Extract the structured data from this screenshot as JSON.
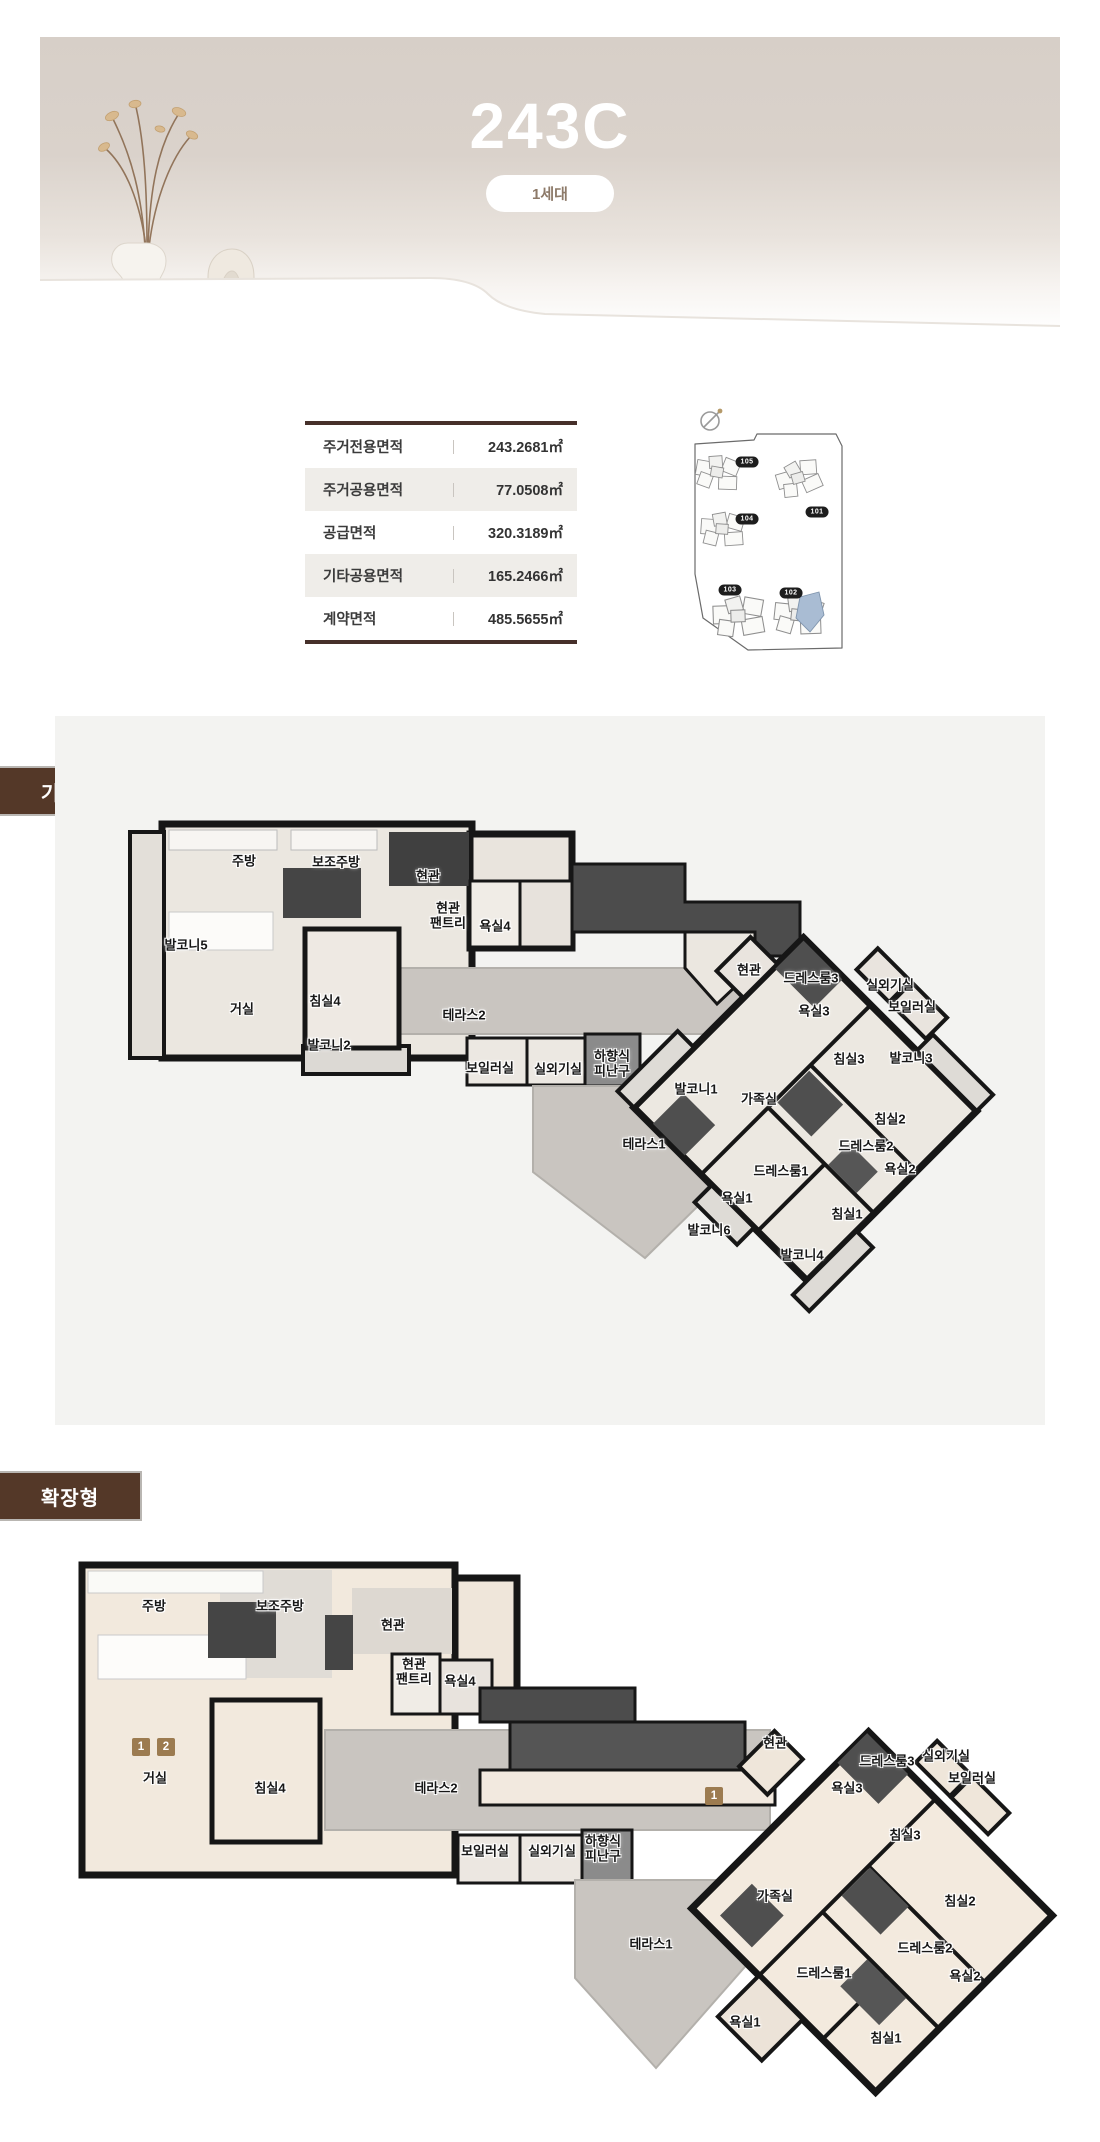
{
  "banner": {
    "unit_name": "243C",
    "household_badge": "1세대"
  },
  "area_table": {
    "rows": [
      {
        "label": "주거전용면적",
        "value": "243.2681㎡"
      },
      {
        "label": "주거공용면적",
        "value": "77.0508㎡"
      },
      {
        "label": "공급면적",
        "value": "320.3189㎡"
      },
      {
        "label": "기타공용면적",
        "value": "165.2466㎡"
      },
      {
        "label": "계약면적",
        "value": "485.5655㎡"
      }
    ]
  },
  "site_map": {
    "highlighted_building": "102",
    "highlight_color": "#a9bcd3",
    "building_badges": [
      {
        "label": "105",
        "x": 61,
        "y": 59
      },
      {
        "label": "101",
        "x": 131,
        "y": 109
      },
      {
        "label": "104",
        "x": 61,
        "y": 116
      },
      {
        "label": "103",
        "x": 44,
        "y": 187
      },
      {
        "label": "102",
        "x": 105,
        "y": 190
      }
    ]
  },
  "sections": {
    "basic": {
      "title": "기본형",
      "rooms": [
        {
          "label": "주방",
          "x": 244,
          "y": 862
        },
        {
          "label": "보조주방",
          "x": 336,
          "y": 863
        },
        {
          "label": "현관",
          "x": 428,
          "y": 877
        },
        {
          "label": "현관\n팬트리",
          "x": 448,
          "y": 916
        },
        {
          "label": "욕실4",
          "x": 495,
          "y": 927
        },
        {
          "label": "발코니5",
          "x": 186,
          "y": 946
        },
        {
          "label": "거실",
          "x": 242,
          "y": 1010
        },
        {
          "label": "침실4",
          "x": 325,
          "y": 1002
        },
        {
          "label": "테라스2",
          "x": 464,
          "y": 1016
        },
        {
          "label": "발코니2",
          "x": 329,
          "y": 1046
        },
        {
          "label": "보일러실",
          "x": 490,
          "y": 1069
        },
        {
          "label": "실외기실",
          "x": 558,
          "y": 1070
        },
        {
          "label": "하향식\n피난구",
          "x": 612,
          "y": 1064
        },
        {
          "label": "현관",
          "x": 749,
          "y": 971
        },
        {
          "label": "드레스룸3",
          "x": 811,
          "y": 979
        },
        {
          "label": "실외기실",
          "x": 890,
          "y": 986
        },
        {
          "label": "욕실3",
          "x": 814,
          "y": 1012
        },
        {
          "label": "보일러실",
          "x": 912,
          "y": 1008
        },
        {
          "label": "침실3",
          "x": 849,
          "y": 1060
        },
        {
          "label": "발코니3",
          "x": 911,
          "y": 1059
        },
        {
          "label": "발코니1",
          "x": 696,
          "y": 1090
        },
        {
          "label": "가족실",
          "x": 759,
          "y": 1100
        },
        {
          "label": "침실2",
          "x": 890,
          "y": 1120
        },
        {
          "label": "드레스룸2",
          "x": 866,
          "y": 1147
        },
        {
          "label": "욕실2",
          "x": 900,
          "y": 1170
        },
        {
          "label": "테라스1",
          "x": 644,
          "y": 1145
        },
        {
          "label": "드레스룸1",
          "x": 781,
          "y": 1172
        },
        {
          "label": "욕실1",
          "x": 737,
          "y": 1199
        },
        {
          "label": "침실1",
          "x": 847,
          "y": 1215
        },
        {
          "label": "발코니6",
          "x": 709,
          "y": 1231
        },
        {
          "label": "발코니4",
          "x": 802,
          "y": 1256
        }
      ]
    },
    "extended": {
      "title": "확장형",
      "badges": [
        {
          "label": "1",
          "x": 141,
          "y": 1747
        },
        {
          "label": "2",
          "x": 166,
          "y": 1747
        },
        {
          "label": "1",
          "x": 714,
          "y": 1796
        }
      ],
      "rooms": [
        {
          "label": "주방",
          "x": 154,
          "y": 1607
        },
        {
          "label": "보조주방",
          "x": 280,
          "y": 1607
        },
        {
          "label": "현관",
          "x": 393,
          "y": 1626
        },
        {
          "label": "현관\n팬트리",
          "x": 414,
          "y": 1672
        },
        {
          "label": "욕실4",
          "x": 460,
          "y": 1682
        },
        {
          "label": "거실",
          "x": 155,
          "y": 1779
        },
        {
          "label": "침실4",
          "x": 270,
          "y": 1789
        },
        {
          "label": "테라스2",
          "x": 436,
          "y": 1789
        },
        {
          "label": "보일러실",
          "x": 485,
          "y": 1852
        },
        {
          "label": "실외기실",
          "x": 552,
          "y": 1852
        },
        {
          "label": "하향식\n피난구",
          "x": 603,
          "y": 1849
        },
        {
          "label": "현관",
          "x": 775,
          "y": 1744
        },
        {
          "label": "드레스룸3",
          "x": 887,
          "y": 1762
        },
        {
          "label": "실외기실",
          "x": 946,
          "y": 1757
        },
        {
          "label": "보일러실",
          "x": 972,
          "y": 1779
        },
        {
          "label": "욕실3",
          "x": 847,
          "y": 1789
        },
        {
          "label": "침실3",
          "x": 905,
          "y": 1836
        },
        {
          "label": "침실2",
          "x": 960,
          "y": 1902
        },
        {
          "label": "가족실",
          "x": 775,
          "y": 1897
        },
        {
          "label": "테라스1",
          "x": 651,
          "y": 1945
        },
        {
          "label": "드레스룸2",
          "x": 925,
          "y": 1949
        },
        {
          "label": "욕실2",
          "x": 965,
          "y": 1977
        },
        {
          "label": "드레스룸1",
          "x": 824,
          "y": 1974
        },
        {
          "label": "욕실1",
          "x": 745,
          "y": 2023
        },
        {
          "label": "침실1",
          "x": 886,
          "y": 2039
        }
      ]
    }
  }
}
